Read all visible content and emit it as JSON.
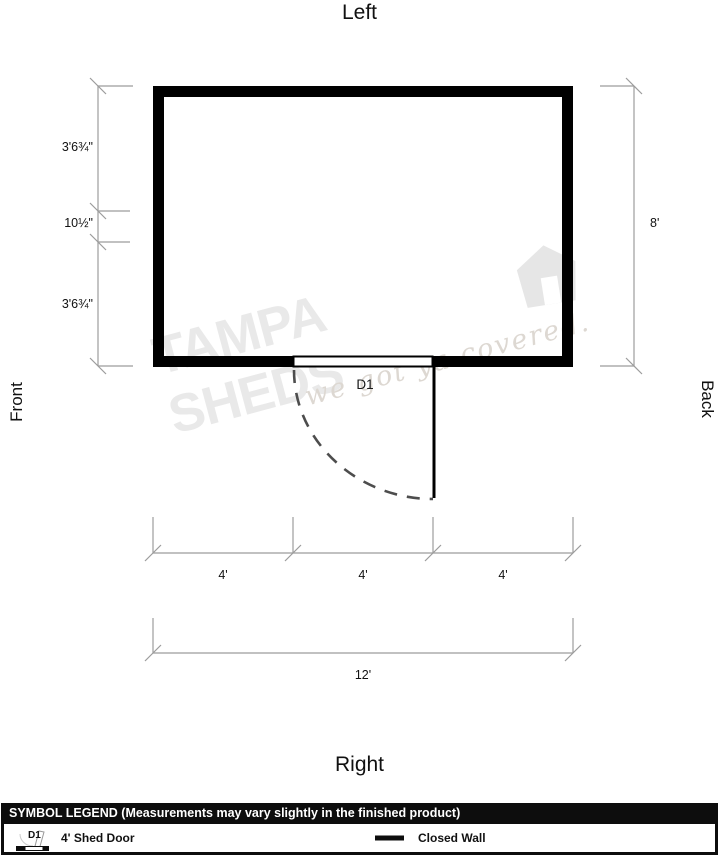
{
  "orientation": {
    "top": "Left",
    "bottom": "Right",
    "left": "Front",
    "right": "Back"
  },
  "door": {
    "label": "D1"
  },
  "dims": {
    "left_segments": [
      "3'6¾\"",
      "10½\"",
      "3'6¾\""
    ],
    "right_total": "8'",
    "bottom_segments": [
      "4'",
      "4'",
      "4'"
    ],
    "bottom_total": "12'"
  },
  "watermark": {
    "brand": "TAMPA SHEDS",
    "tagline": "we got ya covered."
  },
  "legend": {
    "header": "SYMBOL LEGEND (Measurements may vary slightly in the finished product)",
    "door": {
      "symbol": "D1",
      "label": "4' Shed Door"
    },
    "wall": {
      "label": "Closed Wall"
    }
  },
  "colors": {
    "wall": "#000000",
    "dimension_lines": "#9c9c9c",
    "door_swing": "#4d4d4d",
    "watermark_text": "#e9e9e9",
    "legend_header_bg": "#0d0d0d",
    "legend_header_text": "#ffffff"
  }
}
